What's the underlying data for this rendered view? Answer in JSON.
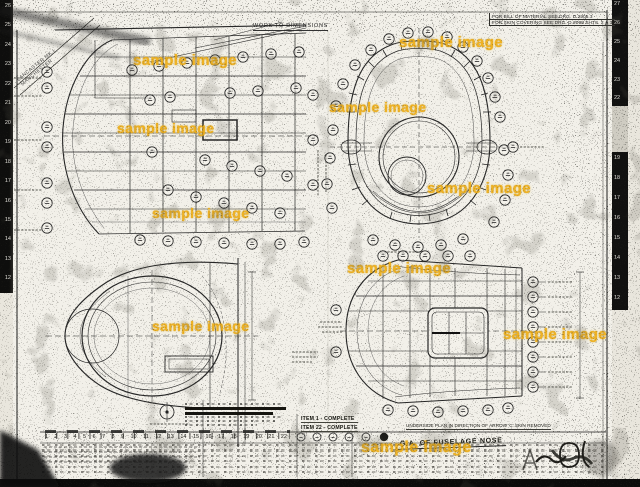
{
  "watermark": {
    "text": "sample image",
    "color": "#efae15"
  },
  "edge_rulers": {
    "left": [
      "26",
      "25",
      "24",
      "23",
      "22",
      "21",
      "20",
      "19",
      "18",
      "17",
      "16",
      "15",
      "14",
      "13",
      "12"
    ],
    "right_top": [
      "27",
      "26",
      "25",
      "24",
      "23",
      "22"
    ],
    "right_bottom": [
      "19",
      "18",
      "17",
      "16",
      "15",
      "14",
      "13",
      "12"
    ],
    "bottom": [
      "1",
      "2",
      "3",
      "4",
      "5",
      "6",
      "7",
      "8",
      "9",
      "10",
      "11",
      "12",
      "13",
      "14",
      "15",
      "16",
      "17",
      "18",
      "19",
      "20",
      "21",
      "22"
    ]
  },
  "notes": {
    "work_to_dimensions": "WORK TO DIMENSIONS",
    "bill_of_material": "FOR BILL OF MATERIAL SEE DRG. D.2305.3",
    "skin_covering": "FOR SKIN COVERING SEE DRG. D.2098 SHTS. 2 & 3",
    "corner_line1": "LANCASTER MK.I",
    "corner_line2": "MANCHESTER"
  },
  "captions": {
    "item_1": "ITEM 1 - COMPLETE",
    "item_22": "ITEM 22 - COMPLETE",
    "underside": "UNDERSIDE PLAN IN DIRECTION OF ARROW 'C' SKIN REMOVED",
    "title": "G.A. OF FUSELAGE NOSE"
  }
}
